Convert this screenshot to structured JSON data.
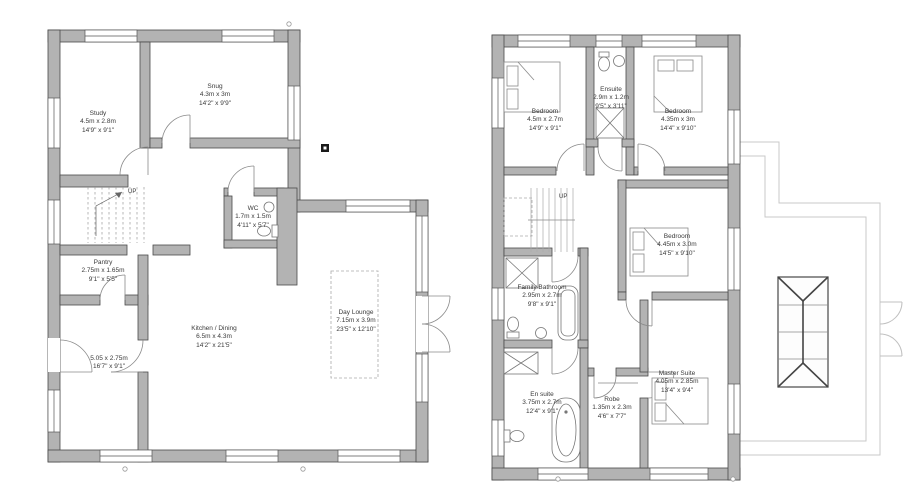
{
  "drawing": {
    "type": "architectural floor plans, ground and first floor",
    "colors": {
      "wall_fill": "#b3b3b3",
      "wall_line": "#4a4a4a",
      "roof_line": "#c9c9c9",
      "text": "#3a3a3a"
    },
    "ground_floor": {
      "stairs_label": "UP",
      "rooms": {
        "study": {
          "name": "Study",
          "metric": "4.5m x 2.8m",
          "imperial": "14'9\" x 9'1\""
        },
        "snug": {
          "name": "Snug",
          "metric": "4.3m x 3m",
          "imperial": "14'2\" x 9'9\""
        },
        "wc": {
          "name": "WC",
          "metric": "1.7m x 1.5m",
          "imperial": "4'11\" x 5'7\""
        },
        "pantry": {
          "name": "Pantry",
          "metric": "2.75m x 1.65m",
          "imperial": "9'1\" x 5'5\""
        },
        "boot_room": {
          "name": "",
          "metric": "5.05 x 2.75m",
          "imperial": "16'7\" x 9'1\""
        },
        "kitchen_dining": {
          "name": "Kitchen / Dining",
          "metric": "6.5m x 4.3m",
          "imperial": "14'2\" x 21'5\""
        },
        "day_lounge": {
          "name": "Day Lounge",
          "metric": "7.15m x 3.9m",
          "imperial": "23'5\" x 12'10\""
        }
      }
    },
    "first_floor": {
      "stairs_label": "UP",
      "rooms": {
        "bedroom_1": {
          "name": "Bedroom",
          "metric": "4.5m x 2.7m",
          "imperial": "14'9\" x 9'1\""
        },
        "ensuite": {
          "name": "Ensuite",
          "metric": "2.9m x 1.2m",
          "imperial": "9'5\" x 3'11\""
        },
        "bedroom_2": {
          "name": "Bedroom",
          "metric": "4.35m x 3m",
          "imperial": "14'4\" x 9'10\""
        },
        "bedroom_3": {
          "name": "Bedroom",
          "metric": "4.45m x 3.0m",
          "imperial": "14'5\" x 9'10\""
        },
        "family_bathroom": {
          "name": "Family Bathroom",
          "metric": "2.95m x 2.7m",
          "imperial": "9'8\" x 9'1\""
        },
        "en_suite": {
          "name": "En suite",
          "metric": "3.75m x 2.7m",
          "imperial": "12'4\" x 9'1\""
        },
        "robe": {
          "name": "Robe",
          "metric": "1.35m x 2.3m",
          "imperial": "4'6\" x 7'7\""
        },
        "master_suite": {
          "name": "Master Suite",
          "metric": "4.05m x 2.85m",
          "imperial": "13'4\" x 9'4\""
        }
      }
    }
  }
}
